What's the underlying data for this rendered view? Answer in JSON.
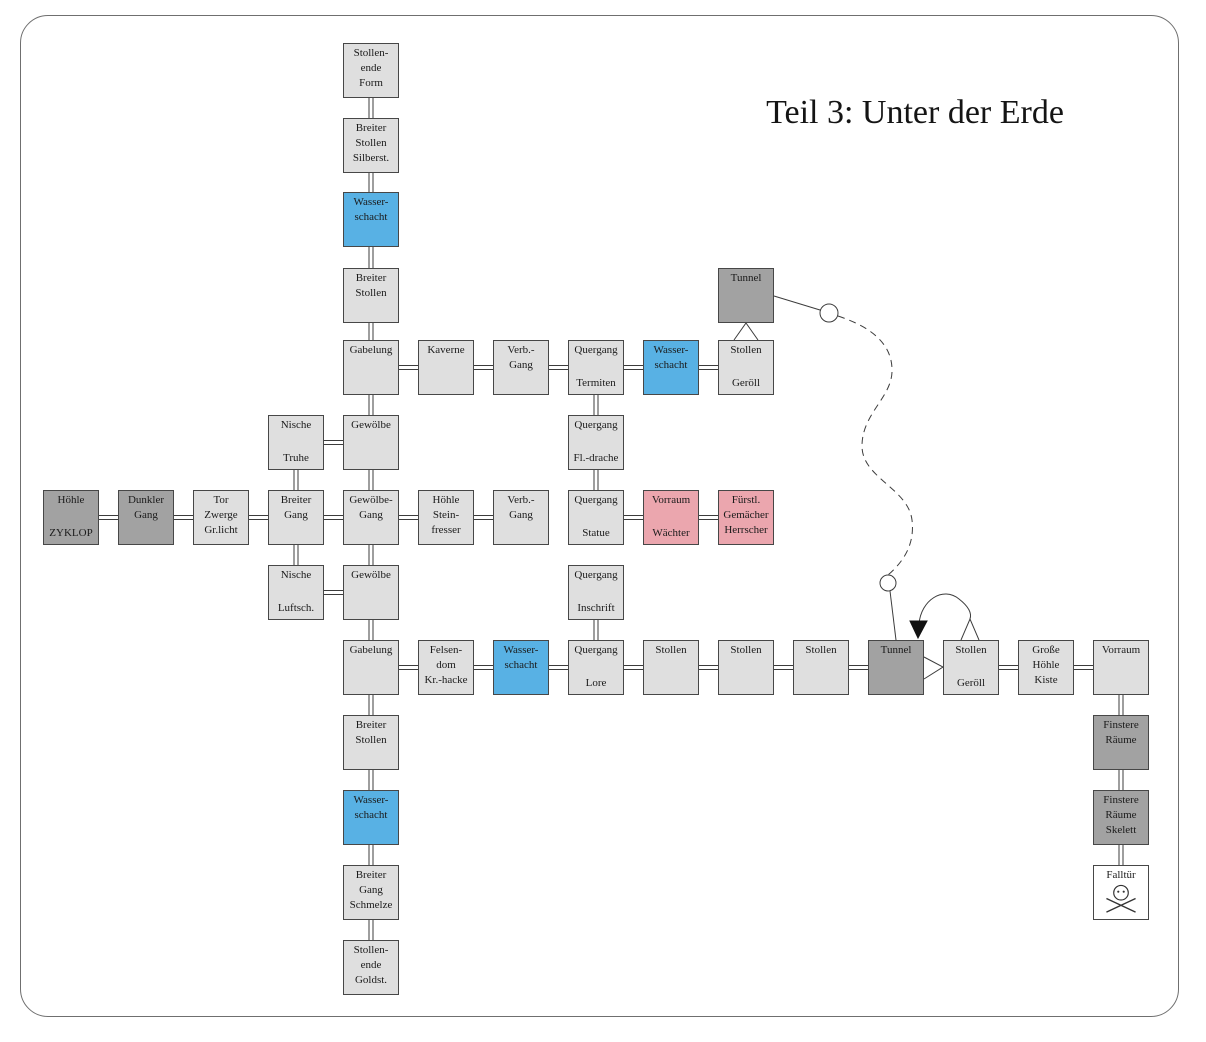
{
  "title": "Teil 3: Unter der Erde",
  "palette": {
    "room_light": "#dfdfdf",
    "room_dark": "#a2a2a2",
    "room_water_blue": "#58b1e4",
    "room_danger_pink": "#eba6ae",
    "room_white": "#ffffff",
    "line": "#3c3c3c",
    "border": "#6f6f6f",
    "arrow_fill": "#111111"
  },
  "grid": {
    "col_x": [
      43,
      118,
      193,
      268,
      343,
      418,
      493,
      568,
      643,
      718,
      793,
      868,
      943,
      1018,
      1093
    ],
    "row_y": [
      43,
      118,
      192,
      268,
      340,
      415,
      490,
      565,
      640,
      715,
      790,
      865,
      940
    ],
    "box_w": 56,
    "box_h": 55
  },
  "rooms": [
    {
      "id": "se_form",
      "col": 4,
      "row": 0,
      "color": "light",
      "top": [
        "Stollen-",
        "ende",
        "Form"
      ]
    },
    {
      "id": "bs_silberst",
      "col": 4,
      "row": 1,
      "color": "light",
      "top": [
        "Breiter",
        "Stollen",
        "Silberst."
      ]
    },
    {
      "id": "ws_a",
      "col": 4,
      "row": 2,
      "color": "blue",
      "top": [
        "Wasser-",
        "schacht"
      ]
    },
    {
      "id": "bs_a",
      "col": 4,
      "row": 3,
      "color": "light",
      "top": [
        "Breiter",
        "Stollen"
      ]
    },
    {
      "id": "gabelung_a",
      "col": 4,
      "row": 4,
      "color": "light",
      "top": [
        "Gabelung"
      ]
    },
    {
      "id": "gewoelbe_a",
      "col": 4,
      "row": 5,
      "color": "light",
      "top": [
        "Gewölbe"
      ]
    },
    {
      "id": "gewoelbe_gang",
      "col": 4,
      "row": 6,
      "color": "light",
      "top": [
        "Gewölbe-",
        "Gang"
      ]
    },
    {
      "id": "gewoelbe_b",
      "col": 4,
      "row": 7,
      "color": "light",
      "top": [
        "Gewölbe"
      ]
    },
    {
      "id": "gabelung_b",
      "col": 4,
      "row": 8,
      "color": "light",
      "top": [
        "Gabelung"
      ]
    },
    {
      "id": "bs_b",
      "col": 4,
      "row": 9,
      "color": "light",
      "top": [
        "Breiter",
        "Stollen"
      ]
    },
    {
      "id": "ws_b",
      "col": 4,
      "row": 10,
      "color": "blue",
      "top": [
        "Wasser-",
        "schacht"
      ]
    },
    {
      "id": "bg_schmelze",
      "col": 4,
      "row": 11,
      "color": "light",
      "top": [
        "Breiter",
        "Gang",
        "Schmelze"
      ]
    },
    {
      "id": "se_goldst",
      "col": 4,
      "row": 12,
      "color": "light",
      "top": [
        "Stollen-",
        "ende",
        "Goldst."
      ]
    },
    {
      "id": "kaverne",
      "col": 5,
      "row": 4,
      "color": "light",
      "top": [
        "Kaverne"
      ]
    },
    {
      "id": "verb_a",
      "col": 6,
      "row": 4,
      "color": "light",
      "top": [
        "Verb.-",
        "Gang"
      ]
    },
    {
      "id": "q_termiten",
      "col": 7,
      "row": 4,
      "color": "light",
      "top": [
        "Quergang"
      ],
      "bottom": [
        "Termiten"
      ]
    },
    {
      "id": "ws_c",
      "col": 8,
      "row": 4,
      "color": "blue",
      "top": [
        "Wasser-",
        "schacht"
      ]
    },
    {
      "id": "st_geroell_a",
      "col": 9,
      "row": 4,
      "color": "light",
      "top": [
        "Stollen"
      ],
      "bottom": [
        "Geröll"
      ]
    },
    {
      "id": "tunnel_a",
      "col": 9,
      "row": 3,
      "color": "dark",
      "top": [
        "Tunnel"
      ]
    },
    {
      "id": "n_truhe",
      "col": 3,
      "row": 5,
      "color": "light",
      "top": [
        "Nische"
      ],
      "bottom": [
        "Truhe"
      ]
    },
    {
      "id": "q_fldrache",
      "col": 7,
      "row": 5,
      "color": "light",
      "top": [
        "Quergang"
      ],
      "bottom": [
        "Fl.-drache"
      ]
    },
    {
      "id": "hoehle_zyklop",
      "col": 0,
      "row": 6,
      "color": "dark",
      "top": [
        "Höhle"
      ],
      "bottom": [
        "ZYKLOP"
      ]
    },
    {
      "id": "dunkler_gang",
      "col": 1,
      "row": 6,
      "color": "dark",
      "top": [
        "Dunkler",
        "Gang"
      ]
    },
    {
      "id": "tor_zwerge",
      "col": 2,
      "row": 6,
      "color": "light",
      "top": [
        "Tor",
        "Zwerge",
        "Gr.licht"
      ]
    },
    {
      "id": "breiter_gang",
      "col": 3,
      "row": 6,
      "color": "light",
      "top": [
        "Breiter",
        "Gang"
      ]
    },
    {
      "id": "h_steinfresser",
      "col": 5,
      "row": 6,
      "color": "light",
      "top": [
        "Höhle",
        "Stein-",
        "fresser"
      ]
    },
    {
      "id": "verb_b",
      "col": 6,
      "row": 6,
      "color": "light",
      "top": [
        "Verb.-",
        "Gang"
      ]
    },
    {
      "id": "q_statue",
      "col": 7,
      "row": 6,
      "color": "light",
      "top": [
        "Quergang"
      ],
      "bottom": [
        "Statue"
      ]
    },
    {
      "id": "v_waechter",
      "col": 8,
      "row": 6,
      "color": "pink",
      "top": [
        "Vorraum"
      ],
      "bottom": [
        "Wächter"
      ]
    },
    {
      "id": "f_gemaecher",
      "col": 9,
      "row": 6,
      "color": "pink",
      "top": [
        "Fürstl.",
        "Gemächer",
        "Herrscher"
      ]
    },
    {
      "id": "n_luftsch",
      "col": 3,
      "row": 7,
      "color": "light",
      "top": [
        "Nische"
      ],
      "bottom": [
        "Luftsch."
      ]
    },
    {
      "id": "q_inschrift",
      "col": 7,
      "row": 7,
      "color": "light",
      "top": [
        "Quergang"
      ],
      "bottom": [
        "Inschrift"
      ]
    },
    {
      "id": "felsendom",
      "col": 5,
      "row": 8,
      "color": "light",
      "top": [
        "Felsen-",
        "dom",
        "Kr.-hacke"
      ]
    },
    {
      "id": "ws_d",
      "col": 6,
      "row": 8,
      "color": "blue",
      "top": [
        "Wasser-",
        "schacht"
      ]
    },
    {
      "id": "q_lore",
      "col": 7,
      "row": 8,
      "color": "light",
      "top": [
        "Quergang"
      ],
      "bottom": [
        "Lore"
      ]
    },
    {
      "id": "stollen_1",
      "col": 8,
      "row": 8,
      "color": "light",
      "top": [
        "Stollen"
      ]
    },
    {
      "id": "stollen_2",
      "col": 9,
      "row": 8,
      "color": "light",
      "top": [
        "Stollen"
      ]
    },
    {
      "id": "stollen_3",
      "col": 10,
      "row": 8,
      "color": "light",
      "top": [
        "Stollen"
      ]
    },
    {
      "id": "tunnel_b",
      "col": 11,
      "row": 8,
      "color": "dark",
      "top": [
        "Tunnel"
      ]
    },
    {
      "id": "st_geroell_b",
      "col": 12,
      "row": 8,
      "color": "light",
      "top": [
        "Stollen"
      ],
      "bottom": [
        "Geröll"
      ]
    },
    {
      "id": "gr_hoehle",
      "col": 13,
      "row": 8,
      "color": "light",
      "top": [
        "Große",
        "Höhle",
        "Kiste"
      ]
    },
    {
      "id": "vorraum",
      "col": 14,
      "row": 8,
      "color": "light",
      "top": [
        "Vorraum"
      ]
    },
    {
      "id": "finstere_1",
      "col": 14,
      "row": 9,
      "color": "dark",
      "top": [
        "Finstere",
        "Räume"
      ]
    },
    {
      "id": "finstere_2",
      "col": 14,
      "row": 10,
      "color": "dark",
      "top": [
        "Finstere",
        "Räume",
        "Skelett"
      ]
    },
    {
      "id": "falltuer",
      "col": 14,
      "row": 11,
      "color": "white",
      "top": [
        "Falltür"
      ],
      "icon": "skull"
    }
  ],
  "edges": [
    [
      "se_form",
      "bs_silberst"
    ],
    [
      "bs_silberst",
      "ws_a"
    ],
    [
      "ws_a",
      "bs_a"
    ],
    [
      "bs_a",
      "gabelung_a"
    ],
    [
      "gabelung_a",
      "gewoelbe_a"
    ],
    [
      "gewoelbe_a",
      "gewoelbe_gang"
    ],
    [
      "gewoelbe_gang",
      "gewoelbe_b"
    ],
    [
      "gewoelbe_b",
      "gabelung_b"
    ],
    [
      "gabelung_b",
      "bs_b"
    ],
    [
      "bs_b",
      "ws_b"
    ],
    [
      "ws_b",
      "bg_schmelze"
    ],
    [
      "bg_schmelze",
      "se_goldst"
    ],
    [
      "n_truhe",
      "breiter_gang"
    ],
    [
      "breiter_gang",
      "n_luftsch"
    ],
    [
      "q_termiten",
      "q_fldrache"
    ],
    [
      "q_fldrache",
      "q_statue"
    ],
    [
      "q_inschrift",
      "q_lore"
    ],
    [
      "vorraum",
      "finstere_1"
    ],
    [
      "finstere_1",
      "finstere_2"
    ],
    [
      "finstere_2",
      "falltuer"
    ],
    [
      "gabelung_a",
      "kaverne"
    ],
    [
      "kaverne",
      "verb_a"
    ],
    [
      "verb_a",
      "q_termiten"
    ],
    [
      "q_termiten",
      "ws_c"
    ],
    [
      "ws_c",
      "st_geroell_a"
    ],
    [
      "n_truhe",
      "gewoelbe_a"
    ],
    [
      "hoehle_zyklop",
      "dunkler_gang"
    ],
    [
      "dunkler_gang",
      "tor_zwerge"
    ],
    [
      "tor_zwerge",
      "breiter_gang"
    ],
    [
      "breiter_gang",
      "gewoelbe_gang"
    ],
    [
      "gewoelbe_gang",
      "h_steinfresser"
    ],
    [
      "h_steinfresser",
      "verb_b"
    ],
    [
      "q_statue",
      "v_waechter"
    ],
    [
      "v_waechter",
      "f_gemaecher"
    ],
    [
      "n_luftsch",
      "gewoelbe_b"
    ],
    [
      "gabelung_b",
      "felsendom"
    ],
    [
      "felsendom",
      "ws_d"
    ],
    [
      "ws_d",
      "q_lore"
    ],
    [
      "q_lore",
      "stollen_1"
    ],
    [
      "stollen_1",
      "stollen_2"
    ],
    [
      "stollen_2",
      "stollen_3"
    ],
    [
      "stollen_3",
      "tunnel_b"
    ],
    [
      "st_geroell_b",
      "gr_hoehle"
    ],
    [
      "gr_hoehle",
      "vorraum"
    ]
  ],
  "special_links": [
    {
      "name": "tunnel-top-to-rubble-wedge",
      "type": "wedge",
      "points": "734,340 746,323 758,340"
    },
    {
      "name": "tunnel-top-to-junction",
      "type": "line",
      "x1": 774,
      "y1": 296,
      "x2": 820,
      "y2": 310
    },
    {
      "name": "junction-circle-top",
      "type": "circle",
      "cx": 829,
      "cy": 313,
      "r": 9
    },
    {
      "name": "dashed-route",
      "type": "dashed-path",
      "d": "M 838 316 C 868 326 893 342 892 372 C 891 398 862 414 862 446 C 862 478 908 488 912 520 C 915 545 903 562 888 575"
    },
    {
      "name": "junction-circle-bottom",
      "type": "circle",
      "cx": 888,
      "cy": 583,
      "r": 8
    },
    {
      "name": "junction-to-tunnel-bottom",
      "type": "line",
      "x1": 890,
      "y1": 591,
      "x2": 896,
      "y2": 640
    },
    {
      "name": "one-way-loop",
      "type": "path",
      "d": "M 919 624 C 921 600 943 586 959 599 C 968 606 972 613 970 619"
    },
    {
      "name": "loop-wedge",
      "type": "wedge",
      "points": "961,640 970,619 979,640"
    },
    {
      "name": "one-way-arrow",
      "type": "arrow",
      "points": "910,621 927,621 918,638"
    },
    {
      "name": "tunnel-bottom-to-rubble-wedge",
      "type": "wedge",
      "points": "924,657 943,667 924,679"
    }
  ]
}
